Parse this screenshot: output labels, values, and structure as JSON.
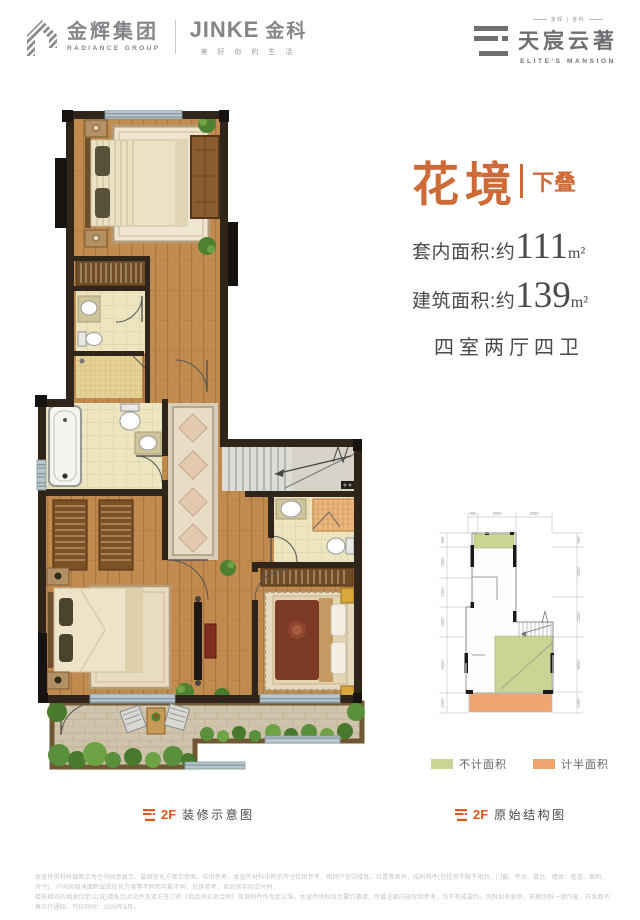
{
  "header": {
    "radiance_cn": "金辉集团",
    "radiance_en": "RADIANCE GROUP",
    "jinke_brand": "JINKE",
    "jinke_cn": "金科",
    "jinke_slogan": "美 好 你 的 生 活",
    "elite_small": "金辉 | 金科",
    "elite_cn": "天宸云著",
    "elite_en": "ELITE'S MANSION"
  },
  "info": {
    "title": "花境",
    "subtitle": "下叠",
    "area_inner_label": "套内面积:约",
    "area_inner_value": "111",
    "area_inner_unit": "m²",
    "area_build_label": "建筑面积:约",
    "area_build_value": "139",
    "area_build_unit": "m²",
    "rooms": "四室两厅四卫"
  },
  "legend": {
    "not_counted": "不计面积",
    "half_counted": "计半面积"
  },
  "captions": {
    "left_floor": "2F",
    "left_label": "装修示意图",
    "right_floor": "2F",
    "right_label": "原始结构图"
  },
  "structural_dims": {
    "top": [
      "950",
      "3000",
      "2900"
    ],
    "left": [
      "600",
      "2500",
      "2300",
      "2200",
      "4600",
      "1300"
    ],
    "right": [
      "600",
      "2500",
      "2300",
      "6800",
      "1300"
    ]
  },
  "colors": {
    "accent_orange": "#CE6A38",
    "caption_orange": "#E8551E",
    "legend_green": "#C9D693",
    "legend_orange": "#F0A470",
    "logo_gray": "#85858A",
    "text_dark": "#4A4A4A",
    "wall_dark": "#30251A",
    "wood_floor": "#C18A4E"
  },
  "disclaimer": {
    "line1": "本宣传资料所载图示为空间创意展示、装修优化方案示意图，仅供参考。本宣传材料中所示尺寸仅供参考，相同户型因楼栋、位置等差异，结构构件(包括但不限于阳台、门窗、平台、露台、墙体、管道、面积、尺寸)，户内局部净面积或因优化方案等不同而可能不同，仅供参考，商品房实际交付时，",
    "line2": "楼栋梯间的相关约定以(或)楼栋比对文件及双方签订的《商品房买卖合同》及其附件作为定义准。本宣传资料仅为要约邀请，所载全部内容仅供参考，均不构成要约。资料如有更新，前期资料一律作废，开发商不再另行通知。刊印时间：2020年6月。"
  }
}
